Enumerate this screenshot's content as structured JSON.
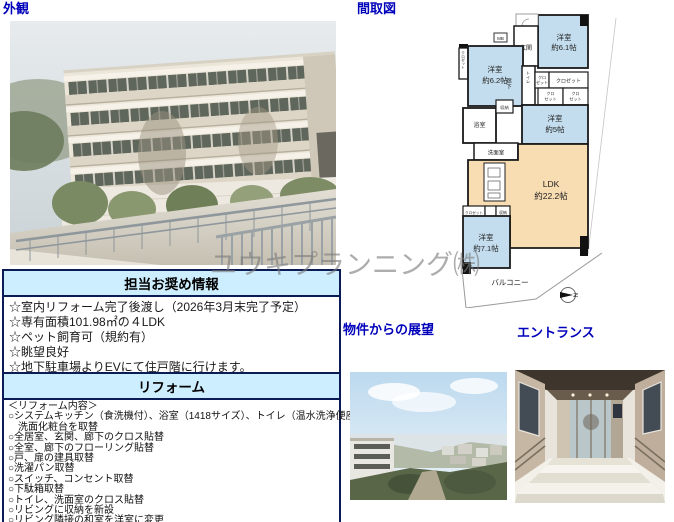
{
  "page": {
    "watermark": "ユウキプランニング㈱"
  },
  "labels": {
    "exterior": "外観",
    "floorplan": "間取図",
    "view": "物件からの展望",
    "entrance": "エントランス"
  },
  "recommend": {
    "title": "担当お奨め情報",
    "items": [
      "☆室内リフォーム完了後渡し（2026年3月末完了予定）",
      "☆専有面積101.98㎡の４LDK",
      "☆ペット飼育可（規約有）",
      "☆眺望良好",
      "☆地下駐車場よりEVにて住戸階に行けます。"
    ]
  },
  "reform": {
    "title": "リフォーム",
    "heading": "＜リフォーム内容＞",
    "items": [
      "○システムキッチン（食洗機付）、浴室（1418サイズ）、トイレ（温水洗浄便座付）、",
      "　洗面化粧台を取替",
      "○全居室、玄関、廊下のクロス貼替",
      "○全室、廊下のフローリング貼替",
      "○戸、扉の建具取替",
      "○洗濯パン取替",
      "○スイッチ、コンセント取替",
      "○下駄箱取替",
      "○トイレ、洗面室のクロス貼替",
      "○リビングに収納を新設",
      "○リビング隣接の和室を洋室に変更"
    ]
  },
  "floorplan": {
    "rooms": {
      "b61": {
        "name": "洋室",
        "size": "約6.1帖"
      },
      "b62": {
        "name": "洋室",
        "size": "約6.2帖"
      },
      "b5": {
        "name": "洋室",
        "size": "約5帖"
      },
      "b71": {
        "name": "洋室",
        "size": "約7.1帖"
      },
      "ldk": {
        "name": "LDK",
        "size": "約22.2帖"
      }
    },
    "labels": {
      "genkan": "玄関",
      "toilet": "トイレ",
      "hallway": "廊下",
      "bath": "浴室",
      "washroom": "洗面室",
      "storage": "収納",
      "closet": "クロゼット",
      "closet_a": "クロ",
      "closet_b": "ゼット",
      "balcony": "バルコニー",
      "mb": "MB",
      "north": "N"
    },
    "colors": {
      "room": "#c3ddee",
      "ldk": "#f8dcb2",
      "wall": "#1a1a1a"
    }
  }
}
